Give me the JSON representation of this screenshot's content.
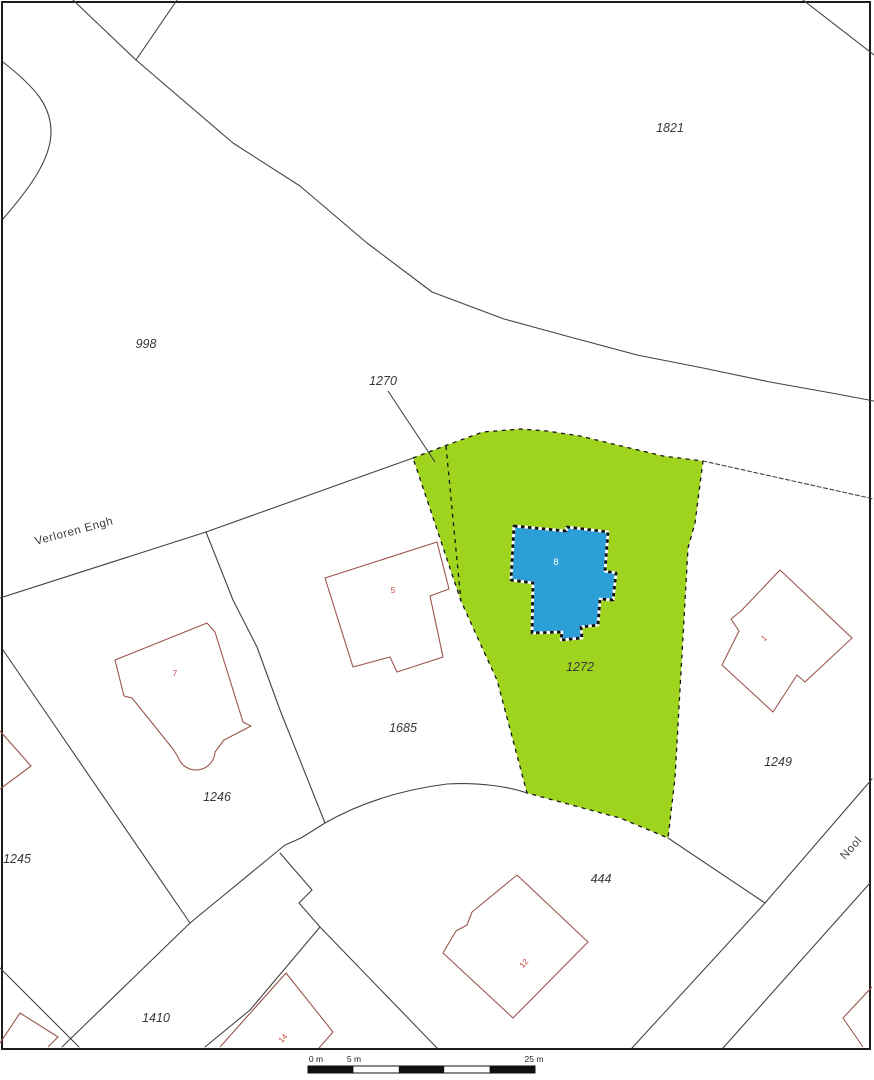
{
  "map": {
    "title": "cadastral parcel map",
    "colors": {
      "background": "#ffffff",
      "border": "#1c1c1c",
      "boundary_line": "#434343",
      "house_outline": "#9a564c",
      "house_number": "#c2443a",
      "parcel_label": "#383838",
      "street_label": "#3a3a3a",
      "highlight_fill": "#9fd41e",
      "highlight_edge": "#161616",
      "building_fill": "#2c9fd9",
      "building_edge_white": "#ffffff",
      "building_edge_black": "#101010",
      "building_label": "#ffffff",
      "scalebar_black": "#111111"
    },
    "border": {
      "x": 2,
      "y": 2,
      "w": 868,
      "h": 1047
    },
    "boundaries": [
      {
        "name": "left-edge-arc",
        "d": "M3,62 C36,88 51,106 51,132 C51,160 28,190 3,219"
      },
      {
        "name": "top-fork-west",
        "d": "M73,0 L136,60"
      },
      {
        "name": "top-fork-east",
        "d": "M177,0 L136,60"
      },
      {
        "name": "road-north-curve-998-1821",
        "d": "M136,60 L233,143 L300,186 L367,243 L432,292 L504,319 L570,337 L637,355 L703,368 L770,382 L837,394 L874,401"
      },
      {
        "name": "corner-cut-1821",
        "d": "M803,0 L874,55"
      },
      {
        "name": "verloren-engh-south-line",
        "d": "M0,598 L206,532 L413,458"
      },
      {
        "name": "boundary-1246-1685",
        "d": "M206,532 L233,600 L257,647 L280,710 L325,823"
      },
      {
        "name": "road-south-right-1249",
        "d": "M703,461 L874,499",
        "dash": "4 2.5"
      },
      {
        "name": "road-edge-lower-west",
        "d": "M190,923 L285,845 L301,838 L325,823"
      },
      {
        "name": "road-curve-lower",
        "d": "M325,823 C360,803 400,790 447,784 C480,782 510,787 527,793"
      },
      {
        "name": "road-edge-444-south",
        "d": "M668,838 L765,903"
      },
      {
        "name": "nool-street-west-line",
        "d": "M872,779 L765,903 L632,1048"
      },
      {
        "name": "nool-street-east-line",
        "d": "M870,883 L723,1048"
      },
      {
        "name": "boundary-1245-1246",
        "d": "M3,650 L190,923"
      },
      {
        "name": "boundary-1245-south",
        "d": "M190,923 L62,1047"
      },
      {
        "name": "boundary-1245-corner",
        "d": "M0,968 L79,1047"
      },
      {
        "name": "staircase-boundary",
        "d": "M280,853 L312,890 L299,903 L320,927"
      },
      {
        "name": "boundary-1410-east",
        "d": "M320,927 L437,1048"
      },
      {
        "name": "boundary-1410-house14",
        "d": "M320,927 L250,1010 L205,1047"
      }
    ],
    "leader_line": {
      "name": "leader-1270",
      "d": "M388,391 L435,462"
    },
    "highlight_parcel": {
      "number": "1272",
      "outline": "M413,458 L447,445 L483,432 L520,429 L547,431 L580,436 L613,444 L663,456 L703,461 L695,523 L688,548 L675,778 L668,838 L620,818 L527,793 L497,680 L480,643 L461,601 Z",
      "inner_dashed_line": "M446,446 L455,540 L461,601"
    },
    "building": {
      "number": "8",
      "outline": "M514,526 L566,531 L567,527 L608,532 L605,571 L616,573 L613,600 L600,599 L598,625 L581,627 L582,638 L561,640 L562,632 L532,633 L533,583 L511,580 Z",
      "label": {
        "x": 556,
        "y": 565
      }
    },
    "houses": [
      {
        "name": "house-7",
        "d": "M115,660 L207,623 L215,632 L243,722 L251,726 L224,740 L215,752 A19,19 0 0 1 178,757 L173,749 L132,698 L124,696 Z",
        "number": "7",
        "nx": 175,
        "ny": 676,
        "rot": 0
      },
      {
        "name": "house-5",
        "d": "M325,578 L437,542 L449,589 L430,596 L443,657 L397,672 L390,657 L353,667 Z",
        "number": "5",
        "nx": 393,
        "ny": 593,
        "rot": 0
      },
      {
        "name": "house-1",
        "d": "M780,570 L852,638 L805,682 L797,675 L773,712 L722,665 L739,631 L731,619 L741,611 Z",
        "number": "1",
        "nx": 766,
        "ny": 640,
        "rot": -45
      },
      {
        "name": "house-12",
        "d": "M517,875 L588,942 L513,1018 L443,953 L456,931 L467,925 L472,912 Z",
        "number": "12",
        "nx": 526,
        "ny": 965,
        "rot": -50
      },
      {
        "name": "house-14",
        "d": "M220,1047 L286,973 L333,1032 L319,1048",
        "number": "14",
        "nx": 285,
        "ny": 1040,
        "rot": -50
      },
      {
        "name": "house-1245-partial",
        "d": "M0,731 L31,766 L0,789",
        "number": "",
        "nx": 0,
        "ny": 0,
        "rot": 0
      },
      {
        "name": "house-bottom-left-partial",
        "d": "M0,1043 L20,1013 L58,1037 L48,1047",
        "number": "",
        "nx": 0,
        "ny": 0,
        "rot": 0
      },
      {
        "name": "house-right-edge-partial",
        "d": "M872,987 L843,1018 L863,1047",
        "number": "",
        "nx": 0,
        "ny": 0,
        "rot": 0
      }
    ],
    "parcel_labels": [
      {
        "text": "1821",
        "x": 670,
        "y": 132
      },
      {
        "text": "998",
        "x": 146,
        "y": 348
      },
      {
        "text": "1270",
        "x": 383,
        "y": 385
      },
      {
        "text": "1272",
        "x": 580,
        "y": 671
      },
      {
        "text": "1685",
        "x": 403,
        "y": 732
      },
      {
        "text": "1246",
        "x": 217,
        "y": 801
      },
      {
        "text": "1245",
        "x": 17,
        "y": 863
      },
      {
        "text": "1249",
        "x": 778,
        "y": 766
      },
      {
        "text": "444",
        "x": 601,
        "y": 883
      },
      {
        "text": "1410",
        "x": 156,
        "y": 1022
      }
    ],
    "street_labels": [
      {
        "name": "street-label-verloren-engh",
        "text": "Verloren Engh",
        "x": 36,
        "y": 545,
        "rot": -15
      },
      {
        "name": "street-label-nool",
        "text": "Nool",
        "x": 845,
        "y": 860,
        "rot": -48
      }
    ]
  },
  "scale_bar": {
    "x": 308,
    "y": 1066,
    "w": 227,
    "h": 7,
    "segments": 5,
    "labels": [
      {
        "text": "0 m",
        "x": 316
      },
      {
        "text": "5 m",
        "x": 354
      },
      {
        "text": "25 m",
        "x": 534
      }
    ]
  }
}
